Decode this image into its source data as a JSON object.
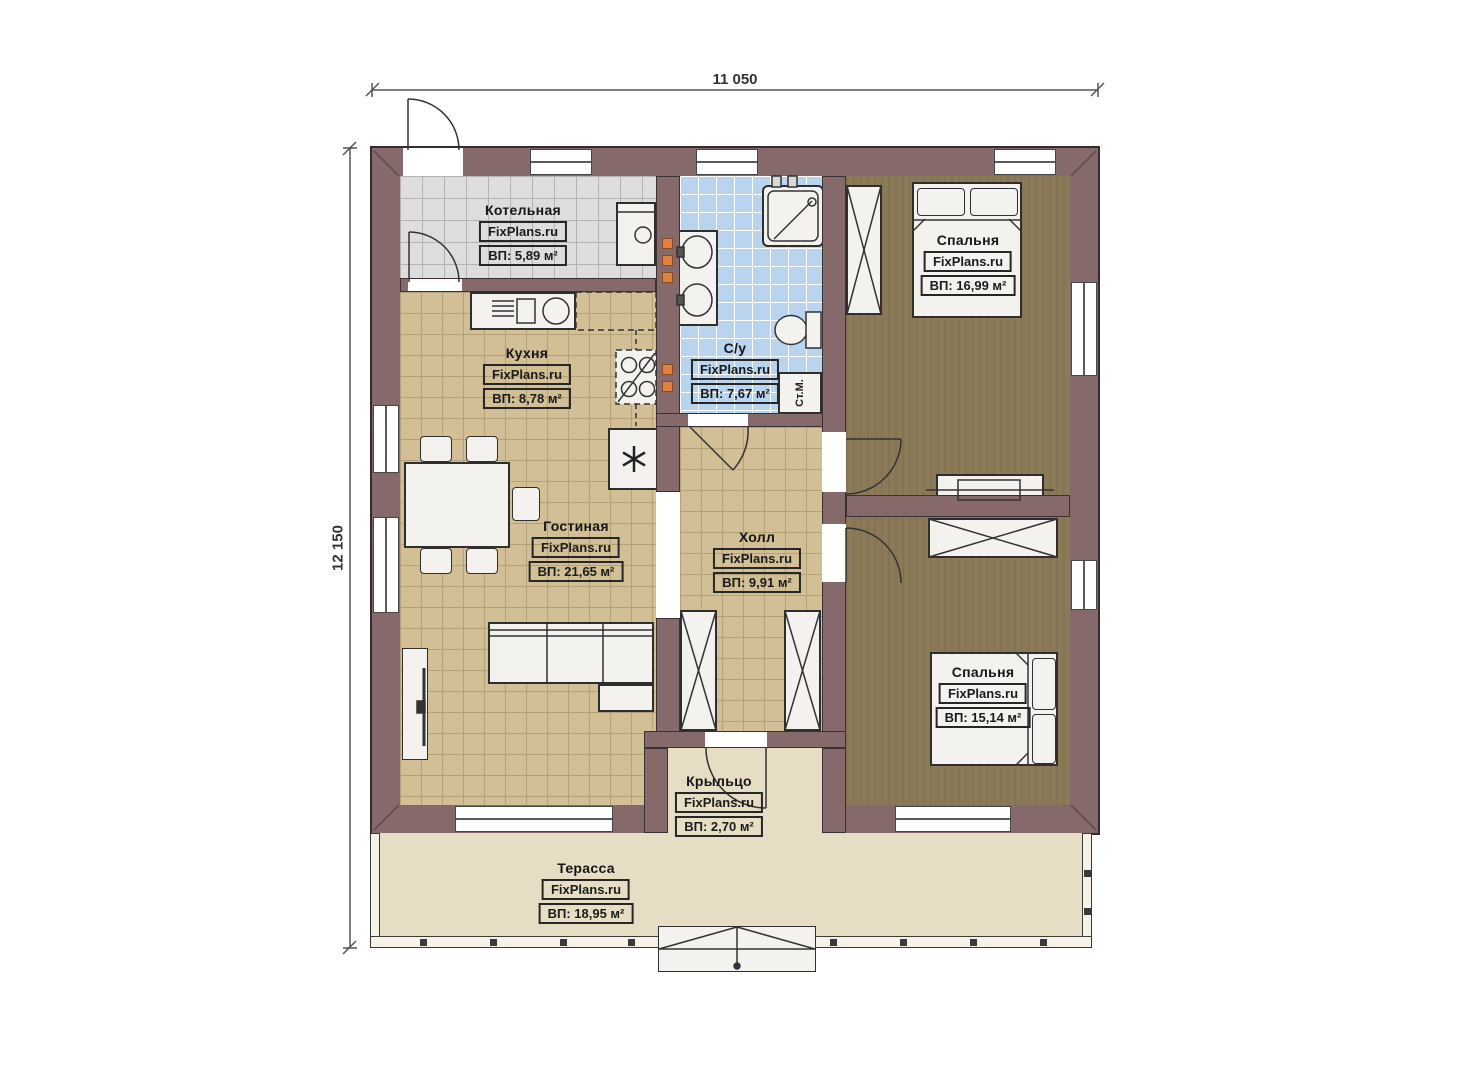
{
  "dimensions": {
    "width_label": "11 050",
    "height_label": "12 150"
  },
  "rooms": [
    {
      "id": "boiler",
      "name": "Котельная",
      "brand": "FixPlans.ru",
      "area": "ВП: 5,89 м²"
    },
    {
      "id": "kitchen",
      "name": "Кухня",
      "brand": "FixPlans.ru",
      "area": "ВП: 8,78 м²"
    },
    {
      "id": "bathroom",
      "name": "С/у",
      "brand": "FixPlans.ru",
      "area": "ВП: 7,67 м²"
    },
    {
      "id": "bedroom1",
      "name": "Спальня",
      "brand": "FixPlans.ru",
      "area": "ВП: 16,99 м²"
    },
    {
      "id": "living",
      "name": "Гостиная",
      "brand": "FixPlans.ru",
      "area": "ВП: 21,65 м²"
    },
    {
      "id": "hall",
      "name": "Холл",
      "brand": "FixPlans.ru",
      "area": "ВП: 9,91 м²"
    },
    {
      "id": "bedroom2",
      "name": "Спальня",
      "brand": "FixPlans.ru",
      "area": "ВП: 15,14 м²"
    },
    {
      "id": "porch",
      "name": "Крыльцо",
      "brand": "FixPlans.ru",
      "area": "ВП: 2,70 м²"
    },
    {
      "id": "terrace",
      "name": "Терасса",
      "brand": "FixPlans.ru",
      "area": "ВП: 18,95 м²"
    }
  ],
  "fixtures": {
    "washing_machine": "Ст.М.",
    "fridge_symbol": "✳"
  },
  "colors": {
    "wall": "#86696b",
    "floor_tile_tan": "#d2bf96",
    "floor_tile_gray": "#dddddd",
    "floor_tile_blue": "#b9d4ef",
    "floor_wood_dark": "#8b7a57",
    "terrace_beige": "#e7dcc4",
    "accent_orange": "#e2813f"
  }
}
